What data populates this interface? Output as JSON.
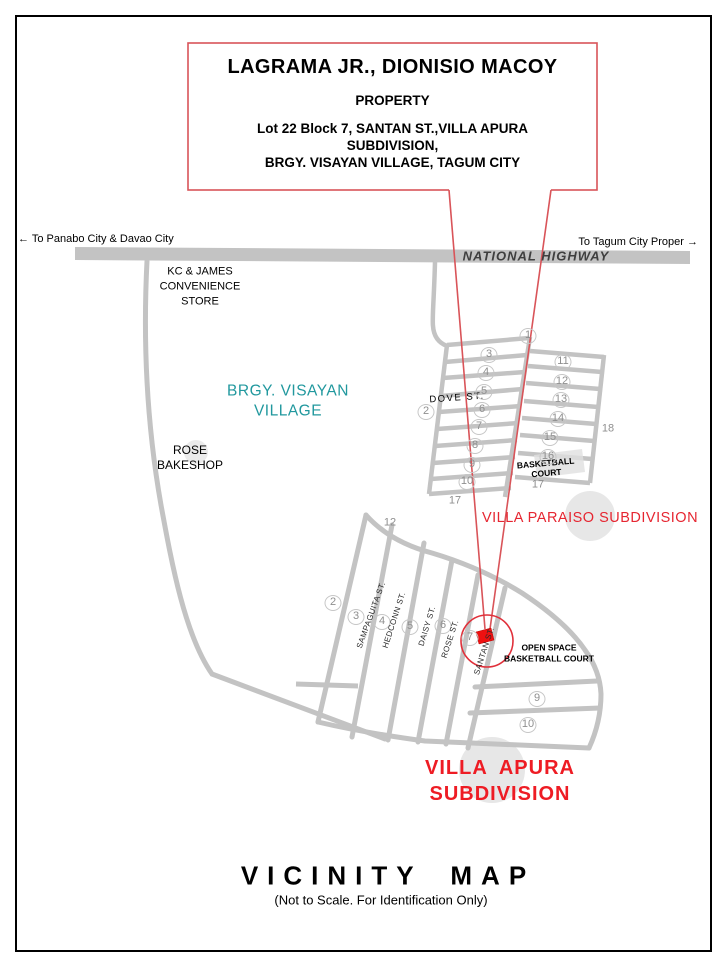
{
  "callout": {
    "owner": "LAGRAMA JR., DIONISIO MACOY",
    "subtitle": "PROPERTY",
    "address_line1": "Lot 22 Block 7, SANTAN ST.,VILLA APURA SUBDIVISION,",
    "address_line2": "BRGY. VISAYAN VILLAGE, TAGUM CITY"
  },
  "highway": {
    "label": "NATIONAL HIGHWAY",
    "left_direction": "← To Panabo City & Davao City",
    "right_direction": "To Tagum City Proper →"
  },
  "landmarks": {
    "convenience_store": "KC & JAMES CONVENIENCE STORE",
    "barangay": "BRGY. VISAYAN VILLAGE",
    "bakeshop": "ROSE BAKESHOP",
    "dove_street": "DOVE ST.",
    "basketball_court": "BASKETBALL COURT",
    "open_space": "OPEN SPACE BASKETBALL COURT"
  },
  "subdivisions": {
    "paraiso": "VILLA PARAISO SUBDIVISION",
    "apura": "VILLA APURA SUBDIVISION"
  },
  "footer": {
    "title": "VICINITY MAP",
    "note": "(Not to Scale. For Identification Only)"
  },
  "map": {
    "block_markers": [
      {
        "label": "1",
        "x": 528,
        "y": 336,
        "circled": true
      },
      {
        "label": "3",
        "x": 489,
        "y": 355,
        "circled": true
      },
      {
        "label": "4",
        "x": 486,
        "y": 373,
        "circled": true
      },
      {
        "label": "5",
        "x": 484,
        "y": 392,
        "circled": true
      },
      {
        "label": "6",
        "x": 482,
        "y": 410,
        "circled": true
      },
      {
        "label": "7",
        "x": 479,
        "y": 427,
        "circled": true
      },
      {
        "label": "8",
        "x": 475,
        "y": 446,
        "circled": true
      },
      {
        "label": "9",
        "x": 472,
        "y": 465,
        "circled": true
      },
      {
        "label": "10",
        "x": 467,
        "y": 482,
        "circled": true
      },
      {
        "label": "17",
        "x": 455,
        "y": 501,
        "circled": false
      },
      {
        "label": "2",
        "x": 426,
        "y": 412,
        "circled": true
      },
      {
        "label": "11",
        "x": 563,
        "y": 362,
        "circled": true
      },
      {
        "label": "12",
        "x": 562,
        "y": 382,
        "circled": true
      },
      {
        "label": "13",
        "x": 561,
        "y": 400,
        "circled": true
      },
      {
        "label": "14",
        "x": 558,
        "y": 419,
        "circled": true
      },
      {
        "label": "15",
        "x": 550,
        "y": 438,
        "circled": true
      },
      {
        "label": "16",
        "x": 548,
        "y": 457,
        "circled": true
      },
      {
        "label": "17",
        "x": 538,
        "y": 485,
        "circled": false
      },
      {
        "label": "18",
        "x": 608,
        "y": 429,
        "circled": false
      },
      {
        "label": "12",
        "x": 390,
        "y": 523,
        "circled": false
      },
      {
        "label": "2",
        "x": 333,
        "y": 603,
        "circled": true
      },
      {
        "label": "3",
        "x": 356,
        "y": 617,
        "circled": true
      },
      {
        "label": "4",
        "x": 382,
        "y": 622,
        "circled": true
      },
      {
        "label": "5",
        "x": 410,
        "y": 627,
        "circled": true
      },
      {
        "label": "6",
        "x": 443,
        "y": 626,
        "circled": true
      },
      {
        "label": "7",
        "x": 470,
        "y": 638,
        "circled": true
      },
      {
        "label": "9",
        "x": 537,
        "y": 699,
        "circled": true
      },
      {
        "label": "10",
        "x": 528,
        "y": 725,
        "circled": true
      }
    ],
    "street_labels": [
      {
        "name": "SAMPAGUITA ST.",
        "x": 371,
        "y": 615,
        "angle": -70
      },
      {
        "name": "HEDCONN ST.",
        "x": 394,
        "y": 620,
        "angle": -72
      },
      {
        "name": "DAISY ST.",
        "x": 427,
        "y": 626,
        "angle": -73
      },
      {
        "name": "ROSE ST.",
        "x": 450,
        "y": 639,
        "angle": -72
      },
      {
        "name": "SANTAN ST.",
        "x": 484,
        "y": 651,
        "angle": -72
      }
    ]
  },
  "colors": {
    "road": "#c3c3c3",
    "red_accent": "#d95459",
    "red_text": "#E62631",
    "marker_red": "#EE1111",
    "teal_text": "#21989E"
  }
}
